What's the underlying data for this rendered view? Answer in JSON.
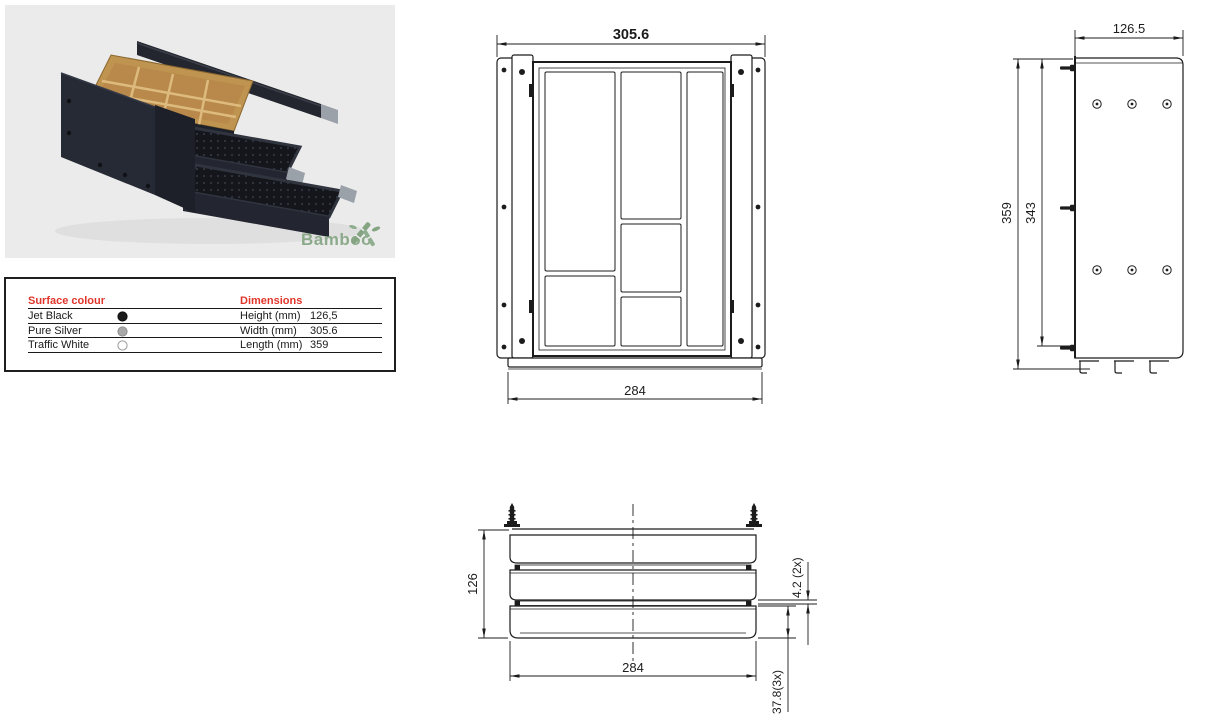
{
  "panel": {
    "logo_text": "Bamboo",
    "logo_color": "#8caa8a",
    "background": "#ebebeb"
  },
  "spec_table": {
    "header_color": "#e0352b",
    "surface_header": "Surface colour",
    "dimensions_header": "Dimensions",
    "surface_colours": [
      {
        "name": "Jet Black",
        "swatch": "#1a1a1a"
      },
      {
        "name": "Pure Silver",
        "swatch": "#a8a8a8"
      },
      {
        "name": "Traffic White",
        "swatch": "#ffffff"
      }
    ],
    "dimensions": [
      {
        "label": "Height (mm)",
        "value": "126,5"
      },
      {
        "label": "Width (mm)",
        "value": "305.6"
      },
      {
        "label": "Length (mm)",
        "value": "359"
      }
    ]
  },
  "drawings": {
    "top_view": {
      "overall_width": "305.6",
      "front_width": "284"
    },
    "side_view": {
      "depth": "126.5",
      "length_outer": "359",
      "length_inner": "343"
    },
    "front_view": {
      "height": "126",
      "width": "284",
      "slot_gap": "4.2 (2x)",
      "front_height": "37.8(3x)"
    }
  }
}
